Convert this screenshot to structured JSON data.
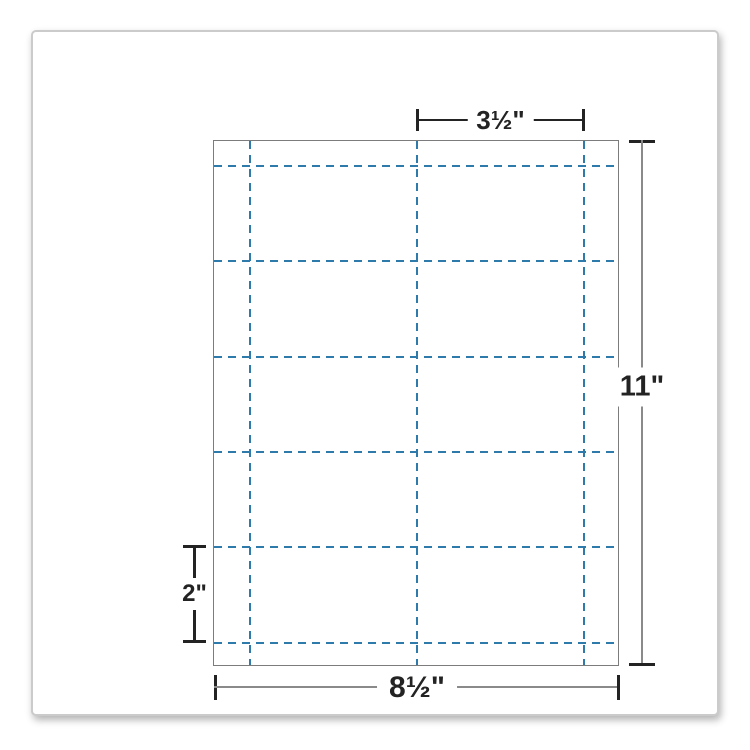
{
  "diagram": {
    "type": "business-card-sheet-template",
    "dimensions": {
      "card_width": "3½\"",
      "card_height": "2\"",
      "sheet_width": "8½\"",
      "sheet_height": "11\""
    },
    "grid": {
      "columns": 2,
      "rows": 5,
      "cells": 10
    },
    "colors": {
      "cut_line_blue": "#2e7aab",
      "sheet_border_gray": "#7c7c7c",
      "dimension_dark": "#232323",
      "dimension_gray": "#8a8a8a",
      "panel_border": "#cbcbcb"
    }
  }
}
